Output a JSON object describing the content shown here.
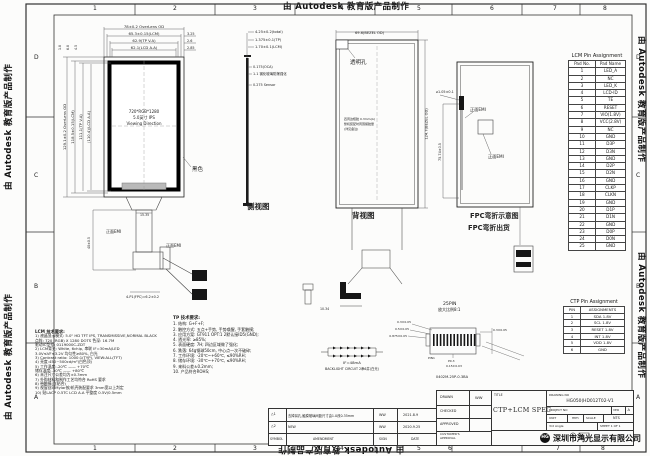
{
  "watermark": "由 Autodesk 教育版产品制作",
  "zones": {
    "cols": [
      "1",
      "2",
      "3",
      "4",
      "5",
      "6",
      "7",
      "8"
    ],
    "rows": [
      "D",
      "C",
      "B",
      "A"
    ]
  },
  "front_view": {
    "top_dims": [
      "78±0.2 OverLens OD",
      "65.3±0.15(LCM)",
      "62.9(TP V.A)",
      "62.1(LCD A.A)"
    ],
    "top_right_dims": [
      "3.25",
      "2.6",
      "2.85"
    ],
    "top_left_dims": [
      "1.8",
      "6.8",
      "4.5"
    ],
    "left_dims": [
      "129.1±0.2 OverLens OD",
      "118.5±0.15(LCM)",
      "111.1(TP V.A)",
      "(110.4)(LCD A.A)"
    ],
    "center_lines": [
      "720*RGB*1280",
      "5.0英寸 IPS",
      "Viewing Direction"
    ],
    "bezel_label": "黑色",
    "emi_label_1": "正面EMI",
    "emi_label_2": "正面EMI",
    "fpc_dim_v": "40±0.5",
    "fpc_dim_h": "15.35",
    "fpc_dim_b": "4-P1(FPC)=6.2±0.2"
  },
  "side_view": {
    "label": "侧视图",
    "dims": [
      "4.25±0.2(total)",
      "1.375±0.1(TP)",
      "1.70±0.1(LCM)"
    ],
    "layer_notes": [
      "0.175(OCA)",
      "1.1 钢化玻璃防爆强化",
      "0.275 Sensor"
    ]
  },
  "back_view": {
    "label": "背视图",
    "top_dim": "69.6(BEZEL OD)",
    "right_dim": "124.7(BEZEL OD)",
    "hole_label": "透明孔",
    "note_lines": [
      "四周边框胶 0.3mm(A)",
      "整机装配时周围留胶量",
      "(详见备注)"
    ],
    "bottom_dim": "10.34"
  },
  "fpc_view": {
    "label_1": "FPC弯折示意图",
    "label_2": "FPC弯折出货",
    "dim_top": "⌀1.05±0.1",
    "dim_side": "75.74±0.5",
    "emi_label_1": "正面EMI",
    "emi_label_2": "正面EMI"
  },
  "connector_detail": {
    "title": "25PIN",
    "scale": "放大比例8:1",
    "part_no": "0402M-25P-0.3BA",
    "dims_left": [
      "0.3±0.05",
      "0.5±0.05",
      "0.875±0.05"
    ],
    "dim_right": "0.3±0.05",
    "dims_bottom": [
      "P0.3",
      "0.15±0.03"
    ],
    "pin1": "PIN1"
  },
  "backlight": {
    "current": "IF=48mA",
    "label": "BACKLIGHT CIRCUIT 2串6并(白光)"
  },
  "lcm_notes": {
    "title": "LCM 技术要求:",
    "lines": [
      "1) 液晶显示模式: 5.0\" HD TFT IPS, TRANSMISSIVE,NORMAL BLACK",
      "    点阵: 720 (RGB) X 1280 DOTS  色深: 16.7M",
      "    驱动IC型号: 0119000C-ZDT",
      "2) LCM背光: White, 6chip, 串联 IF=30mA/LED",
      "    3.0V≤VF≤3.2V  均匀性≥80%, 白光",
      "3) Contrast ratio: 1000:1(TYP), VIEW:ALL(TFT)",
      "4) 亮度:450~500cd/m²(白色顶)",
      "5) 工作温度:-20℃ —— +70℃",
      "    储存温度:-30℃ —— +80℃",
      "6) 未注尺寸公差均为±0.3mm",
      "7) 外购材料和制作工艺均符合 RoHS 要求",
      "8) 带触摸(含贴合)",
      "9) 视窗丝印Mylar按/机壳装配要求 3mm宽以上判定",
      "10) 贴LACP 0.5TC LCD A.A 平整度 0.5V/0.5mm"
    ]
  },
  "tp_notes": {
    "title": "TP 技术要求:",
    "lines": [
      "1. 结构: G+F+F;",
      "2. 触控方式: 五点+手势, 手势唤醒, 手套触摸;",
      "3. 应用方案: GT911 OPT:1 2默认接ID5(GND);",
      "4. 透光率: ≥85%;",
      "5. 表面硬度: 7H; 四边区域做了强化;",
      "6. 跌落: 64g钢球50cm, 中心点一次不破碎;",
      "7. 工作环境: -20℃~+60℃, ≤90%RH;",
      "8. 储存环境: -30℃~+70℃, ≤90%RH;",
      "9. 来料公差±0.2mm;",
      "10. 产品符合ROHS;"
    ]
  },
  "lcm_pin_table": {
    "title": "LCM Pin Assignment",
    "headers": [
      "Pad No.",
      "Pad Name"
    ],
    "rows": [
      [
        "1",
        "LED_A"
      ],
      [
        "2",
        "NC"
      ],
      [
        "3",
        "LED_K"
      ],
      [
        "4",
        "LCD-ID"
      ],
      [
        "5",
        "TE"
      ],
      [
        "6",
        "RESET"
      ],
      [
        "7",
        "VIO(1.8V)"
      ],
      [
        "8",
        "VCC(2.8V)"
      ],
      [
        "9",
        "NC"
      ],
      [
        "10",
        "GND"
      ],
      [
        "11",
        "D3P"
      ],
      [
        "12",
        "D3N"
      ],
      [
        "13",
        "GND"
      ],
      [
        "14",
        "D2P"
      ],
      [
        "15",
        "D2N"
      ],
      [
        "16",
        "GND"
      ],
      [
        "17",
        "CLKP"
      ],
      [
        "18",
        "CLKN"
      ],
      [
        "19",
        "GND"
      ],
      [
        "20",
        "D1P"
      ],
      [
        "21",
        "D1N"
      ],
      [
        "22",
        "GND"
      ],
      [
        "23",
        "D0P"
      ],
      [
        "24",
        "D0N"
      ],
      [
        "25",
        "GND"
      ]
    ]
  },
  "ctp_pin_table": {
    "title": "CTP Pin Assignment",
    "headers": [
      "PIN",
      "ASSIGNMENTS"
    ],
    "rows": [
      [
        "1",
        "SDA 1.8V"
      ],
      [
        "2",
        "SCL 1.8V"
      ],
      [
        "3",
        "RESET 1.8V"
      ],
      [
        "4",
        "INT 1.8V"
      ],
      [
        "5",
        "VDD 1.8V"
      ],
      [
        "6",
        "GND"
      ]
    ]
  },
  "revision_table": {
    "headers": [
      "SYMBOL",
      "AMENDMENT",
      "SIGN",
      "DATE"
    ],
    "rows": [
      {
        "symbol": "△1",
        "amendment": "去掉耳孔,触摸玻璃间距尺寸由1.0改0.35mm",
        "sign": "WW",
        "date": "2021.8.9"
      },
      {
        "symbol": "△2",
        "amendment": "NEW",
        "sign": "WW",
        "date": "2020.9.25"
      }
    ]
  },
  "title_block": {
    "drawn_label": "DRAWN",
    "drawn": "WW",
    "checked_label": "CHECKED",
    "approved_label": "APPROVED",
    "customer_label_1": "CUSTOMER'S",
    "customer_label_2": "APPROVAL",
    "title_label": "TITLE",
    "title": "CTP+LCM SPEC",
    "drawing_no_label": "DRAWING NO",
    "drawing_no": "HG050(HD012T02-V1",
    "project_no_label": "PROJECT NO",
    "ver_label": "VER",
    "ver": "A",
    "unit_label": "UNIT",
    "unit": "mm",
    "scale_label": "SCALE",
    "scale": "NTS",
    "angle_label": "3rd Angle",
    "sheet": "SHEET 1 OF 1",
    "logo": "HG",
    "company": "深圳市鸿光显示有限公司"
  }
}
